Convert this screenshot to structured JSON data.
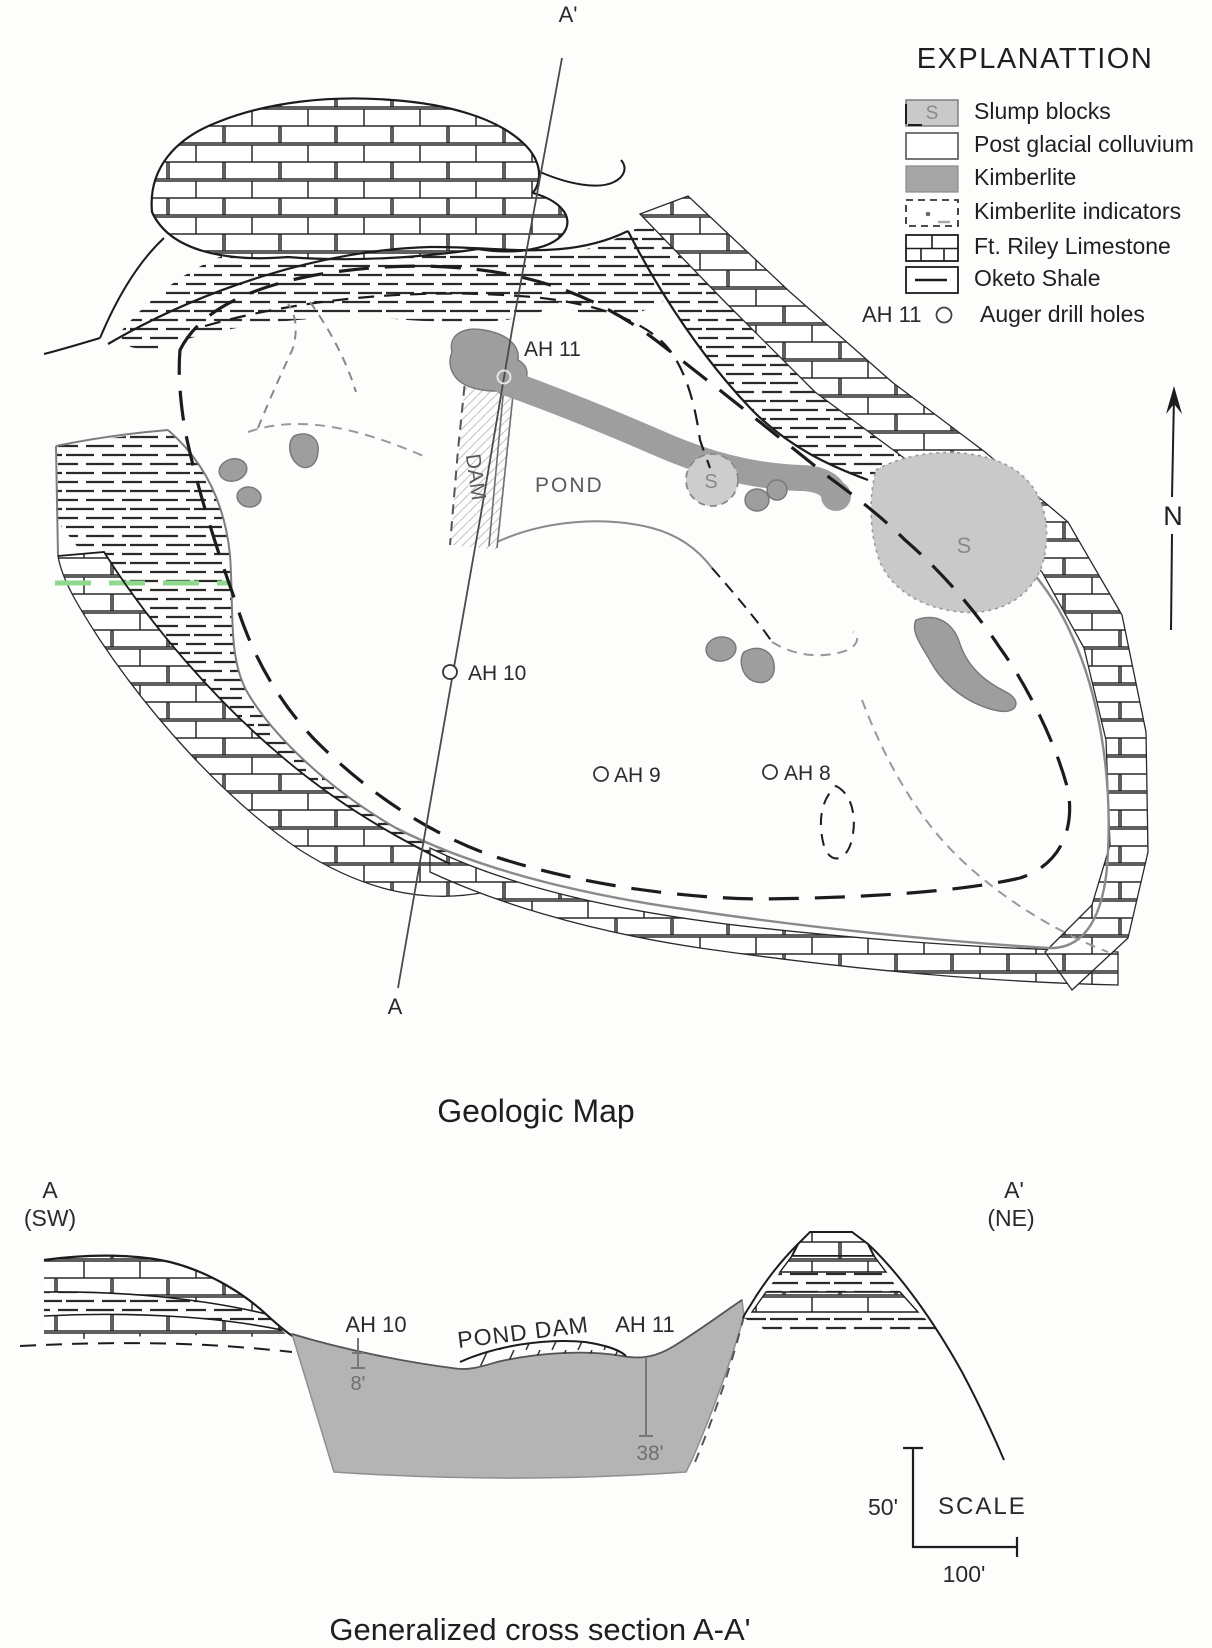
{
  "figure": {
    "map_caption": "Geologic Map",
    "section_caption": "Generalized cross section A-A'"
  },
  "legend": {
    "title": "EXPLANATTION",
    "items": [
      {
        "id": "slump-blocks",
        "label": "Slump blocks",
        "letter": "S"
      },
      {
        "id": "post-glacial-colluvium",
        "label": "Post glacial colluvium"
      },
      {
        "id": "kimberlite",
        "label": "Kimberlite"
      },
      {
        "id": "kimberlite-indicators",
        "label": "Kimberlite indicators"
      },
      {
        "id": "ft-riley-limestone",
        "label": "Ft. Riley Limestone"
      },
      {
        "id": "oketo-shale",
        "label": "Oketo Shale"
      }
    ],
    "drill": {
      "example": "AH 11",
      "label": "Auger drill holes"
    }
  },
  "map": {
    "labels": {
      "ah11": "AH 11",
      "ah10": "AH 10",
      "ah9": "AH 9",
      "ah8": "AH 8",
      "pond": "POND",
      "dam": "DAM",
      "slump_letter": "S",
      "north": "N",
      "section_a": "A",
      "section_a_prime": "A'"
    }
  },
  "cross_section": {
    "left_letter": "A",
    "left_dir": "(SW)",
    "right_letter": "A'",
    "right_dir": "(NE)",
    "ah10": "AH 10",
    "pond_dam": "POND DAM",
    "ah11": "AH 11",
    "ah10_depth": "8'",
    "ah11_depth": "38'",
    "scale_label": "SCALE",
    "scale_v": "50'",
    "scale_h": "100'"
  },
  "colors": {
    "ink": "#1f1f1f",
    "gray_line": "#8f8f8f",
    "kimberlite": "#9e9e9e",
    "slump": "#c9c9c9",
    "section_fill": "#b4b4b4",
    "green_marker": "#8fd98f"
  }
}
